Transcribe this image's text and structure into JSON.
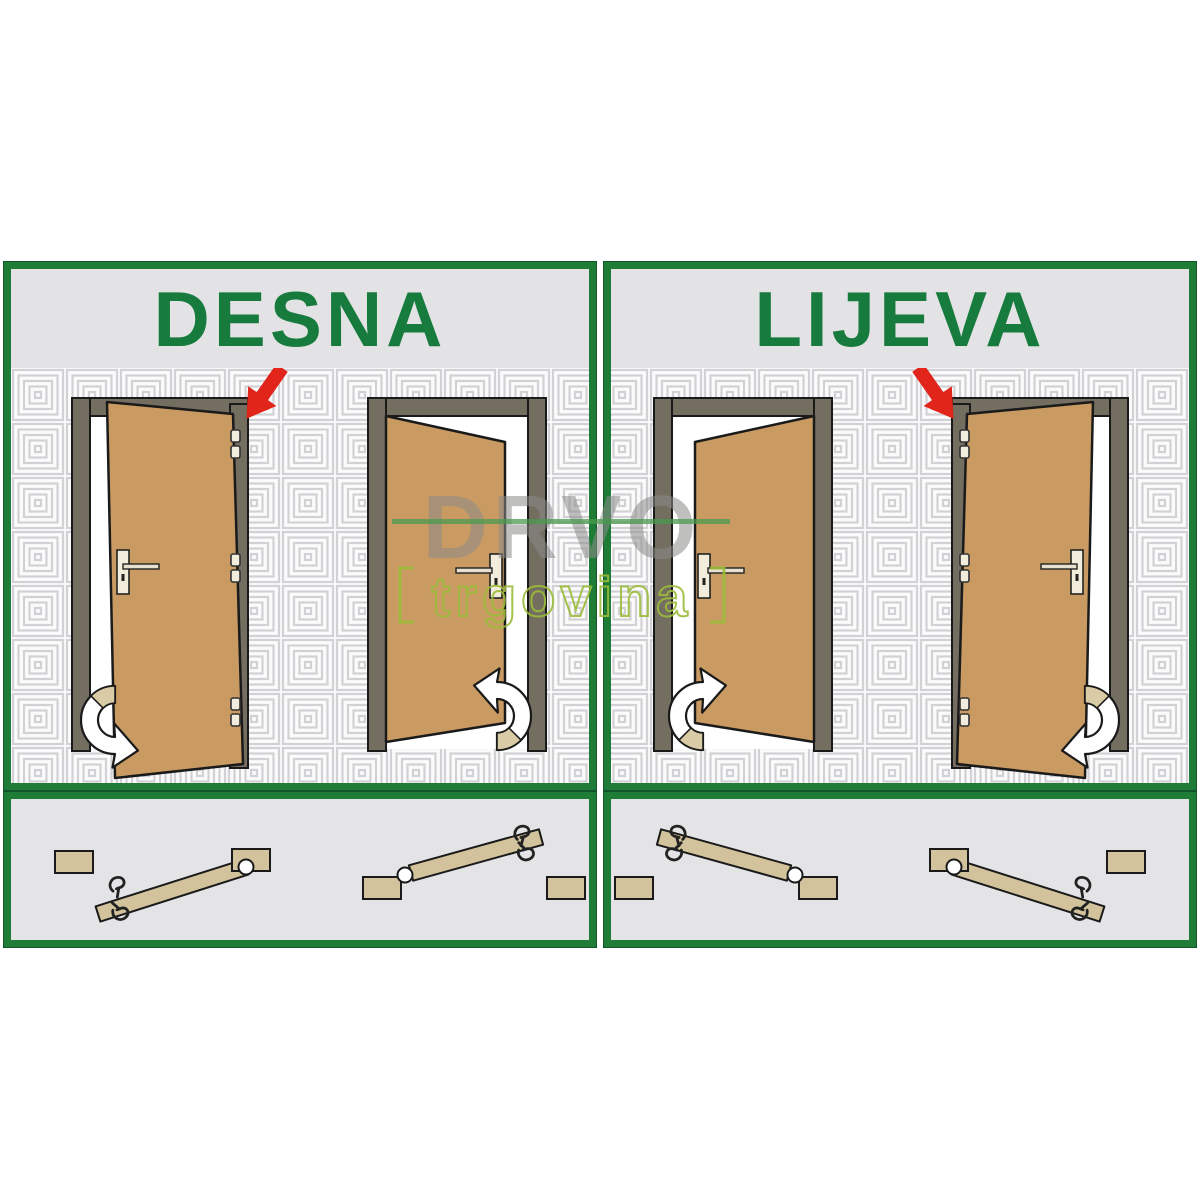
{
  "page": {
    "background": "#ffffff",
    "description": "Door handing diagram: right-hand vs left-hand doors"
  },
  "watermark": {
    "brand": "DRVO",
    "sub": "trgovina"
  },
  "panels": [
    {
      "title": "DESNA",
      "doors": [
        {
          "position": "left",
          "hinge_side": "right",
          "swing": "toward viewer",
          "hinges_visible": 3,
          "red_arrow_on_hinge_side": true,
          "swing_arrow": "bottom-left pointing right"
        },
        {
          "position": "right",
          "hinge_side": "left",
          "swing": "away from viewer",
          "hinges_visible": 0,
          "red_arrow_on_hinge_side": false,
          "swing_arrow": "bottom-right pointing left"
        }
      ],
      "hardware_diagrams": [
        {
          "pivot_circle": "right end",
          "handle_hooks": "left end",
          "bar_tilt": "rises to the right"
        },
        {
          "pivot_circle": "left end",
          "handle_hooks": "right end",
          "bar_tilt": "rises to the right"
        }
      ]
    },
    {
      "title": "LIJEVA",
      "doors": [
        {
          "position": "left",
          "hinge_side": "right",
          "swing": "away from viewer",
          "hinges_visible": 0,
          "red_arrow_on_hinge_side": false,
          "swing_arrow": "bottom-left pointing right"
        },
        {
          "position": "right",
          "hinge_side": "left",
          "swing": "toward viewer",
          "hinges_visible": 3,
          "red_arrow_on_hinge_side": true,
          "swing_arrow": "bottom-right pointing left"
        }
      ],
      "hardware_diagrams": [
        {
          "pivot_circle": "right end",
          "handle_hooks": "left end",
          "bar_tilt": "falls to the right"
        },
        {
          "pivot_circle": "left end",
          "handle_hooks": "right end",
          "bar_tilt": "falls to the right"
        }
      ]
    }
  ],
  "colors": {
    "panel_border_green": "#1f7c37",
    "title_green": "#177b3e",
    "panel_bg_gray": "#e3e3e5",
    "pattern_line_gray": "#d2d2d4",
    "door_leaf_tan": "#c99b63",
    "door_frame_gray": "#746e60",
    "red_arrow": "#e2251b",
    "swing_arrow_white": "#ffffff",
    "swing_arrow_tail_tan": "#d8cba6",
    "hardware_tan": "#d3c39c",
    "watermark_gray": "#8b8b89",
    "watermark_green": "#9bbc3a"
  }
}
